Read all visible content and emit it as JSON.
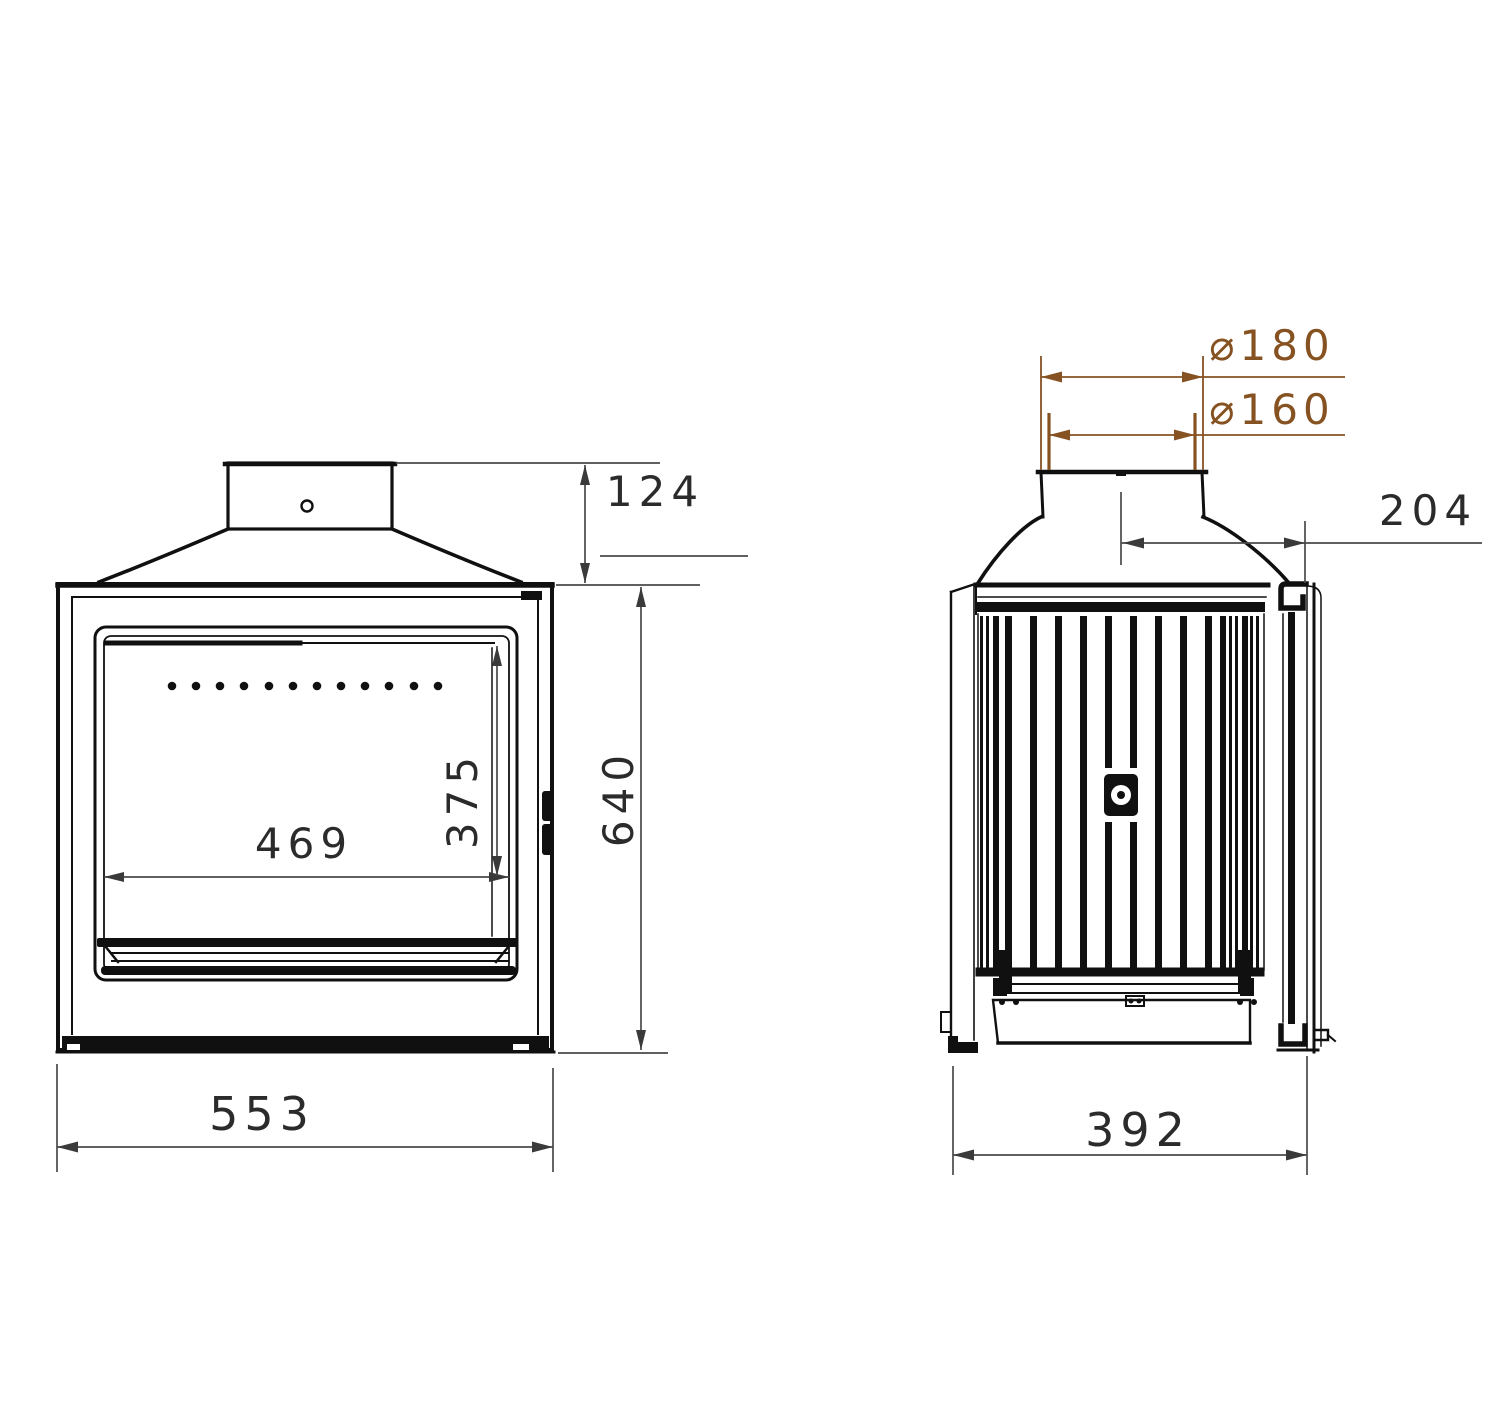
{
  "front_view": {
    "dimensions": {
      "flue_collar_height": "124",
      "overall_height": "640",
      "glass_width": "469",
      "glass_height": "375",
      "overall_width": "553"
    }
  },
  "side_view": {
    "dimensions": {
      "flue_outer_diameter": "⌀180",
      "flue_inner_diameter": "⌀160",
      "flue_center_to_front": "204",
      "overall_depth": "392"
    }
  },
  "colors": {
    "line": "#101010",
    "dimension_text": "#2b2b2b",
    "diameter_dimension": "#865222",
    "background": "#ffffff"
  }
}
